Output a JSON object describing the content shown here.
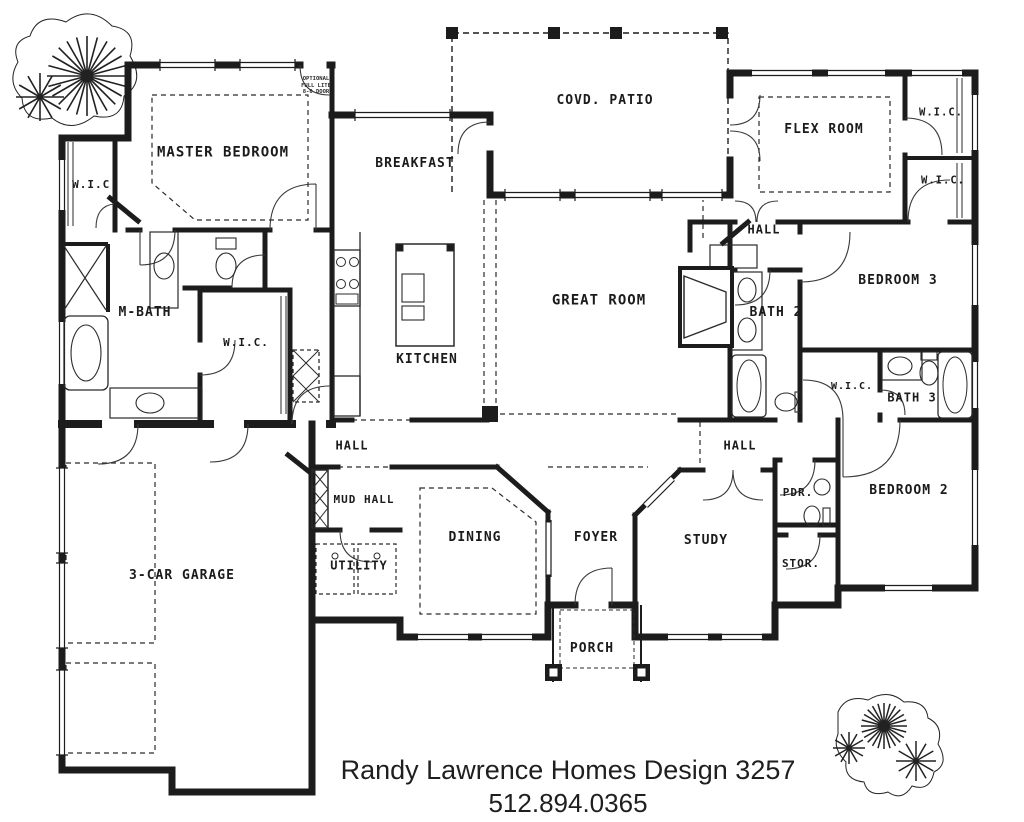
{
  "page": {
    "paper_color": "#ffffff",
    "ink_color": "#1c1c1c"
  },
  "footer": {
    "line1": "Randy Lawrence Homes Design 3257",
    "line2": "512.894.0365"
  },
  "floor_plan": {
    "rooms": [
      {
        "id": "master-bedroom",
        "label": "MASTER BEDROOM",
        "x": 223,
        "y": 153,
        "fs": 14
      },
      {
        "id": "wic-master-left",
        "label": "W.I.C.",
        "x": 95,
        "y": 185,
        "fs": 11
      },
      {
        "id": "m-bath",
        "label": "M-BATH",
        "x": 145,
        "y": 313,
        "fs": 13
      },
      {
        "id": "wic-master-2",
        "label": "W.I.C.",
        "x": 246,
        "y": 343,
        "fs": 11
      },
      {
        "id": "breakfast",
        "label": "BREAKFAST",
        "x": 415,
        "y": 164,
        "fs": 13
      },
      {
        "id": "kitchen",
        "label": "KITCHEN",
        "x": 427,
        "y": 360,
        "fs": 13
      },
      {
        "id": "covd-patio",
        "label": "COVD. PATIO",
        "x": 605,
        "y": 101,
        "fs": 13
      },
      {
        "id": "great-room",
        "label": "GREAT ROOM",
        "x": 599,
        "y": 301,
        "fs": 14
      },
      {
        "id": "flex-room",
        "label": "FLEX ROOM",
        "x": 824,
        "y": 130,
        "fs": 13
      },
      {
        "id": "wic-right-1",
        "label": "W.I.C.",
        "x": 941,
        "y": 113,
        "fs": 10.5
      },
      {
        "id": "wic-right-2",
        "label": "W.I.C.",
        "x": 943,
        "y": 181,
        "fs": 10.5
      },
      {
        "id": "hall-top",
        "label": "HALL",
        "x": 764,
        "y": 230,
        "fs": 12
      },
      {
        "id": "bath-2",
        "label": "BATH 2",
        "x": 776,
        "y": 313,
        "fs": 13
      },
      {
        "id": "bedroom-3",
        "label": "BEDROOM 3",
        "x": 898,
        "y": 281,
        "fs": 13
      },
      {
        "id": "wic-bath3",
        "label": "W.I.C.",
        "x": 852,
        "y": 387,
        "fs": 10
      },
      {
        "id": "bath-3",
        "label": "BATH 3",
        "x": 912,
        "y": 398,
        "fs": 12
      },
      {
        "id": "hall-left",
        "label": "HALL",
        "x": 352,
        "y": 446,
        "fs": 12
      },
      {
        "id": "hall-right",
        "label": "HALL",
        "x": 740,
        "y": 446,
        "fs": 12
      },
      {
        "id": "mud-hall",
        "label": "MUD HALL",
        "x": 364,
        "y": 500,
        "fs": 11
      },
      {
        "id": "dining",
        "label": "DINING",
        "x": 475,
        "y": 538,
        "fs": 13
      },
      {
        "id": "foyer",
        "label": "FOYER",
        "x": 596,
        "y": 538,
        "fs": 13
      },
      {
        "id": "study",
        "label": "STUDY",
        "x": 706,
        "y": 541,
        "fs": 13
      },
      {
        "id": "pdr",
        "label": "PDR.",
        "x": 798,
        "y": 493,
        "fs": 11
      },
      {
        "id": "stor",
        "label": "STOR.",
        "x": 801,
        "y": 564,
        "fs": 11
      },
      {
        "id": "bedroom-2",
        "label": "BEDROOM 2",
        "x": 909,
        "y": 491,
        "fs": 13
      },
      {
        "id": "utility",
        "label": "UTILITY",
        "x": 359,
        "y": 566,
        "fs": 12
      },
      {
        "id": "garage",
        "label": "3-CAR GARAGE",
        "x": 182,
        "y": 576,
        "fs": 13
      },
      {
        "id": "porch",
        "label": "PORCH",
        "x": 592,
        "y": 649,
        "fs": 13
      }
    ],
    "annotations": [
      {
        "id": "optional-door-note",
        "label": "OPTIONAL\nFULL LITE\n8-0 DOOR",
        "x": 316,
        "y": 86,
        "fs": 5.5
      }
    ]
  }
}
